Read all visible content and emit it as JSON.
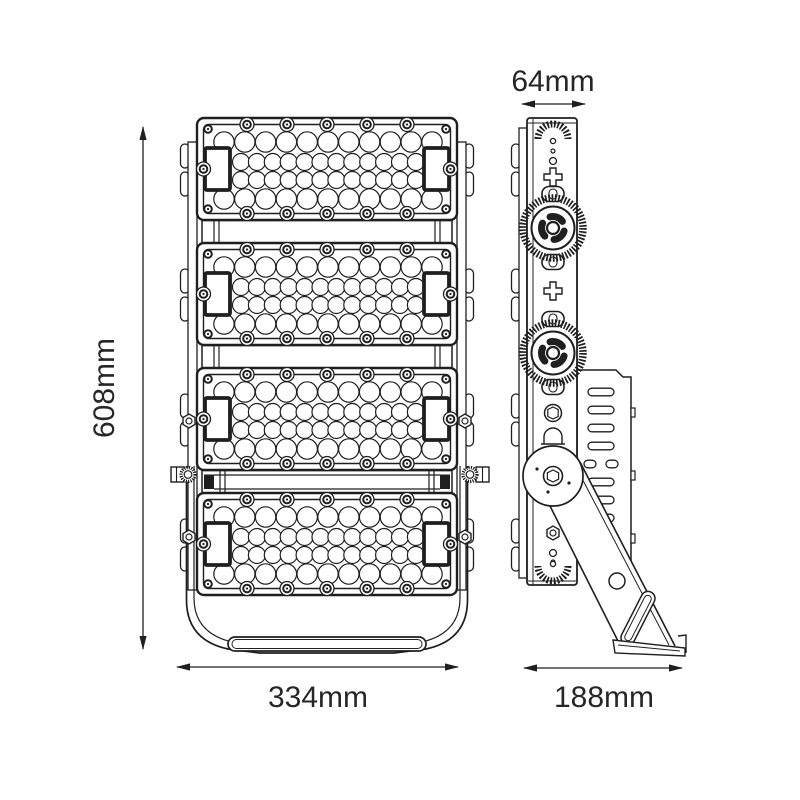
{
  "dimensions": {
    "height": "608mm",
    "width": "334mm",
    "thickness": "64mm",
    "depth": "188mm"
  },
  "colors": {
    "line": "#1f1f1f",
    "background": "#ffffff",
    "text": "#262626"
  }
}
